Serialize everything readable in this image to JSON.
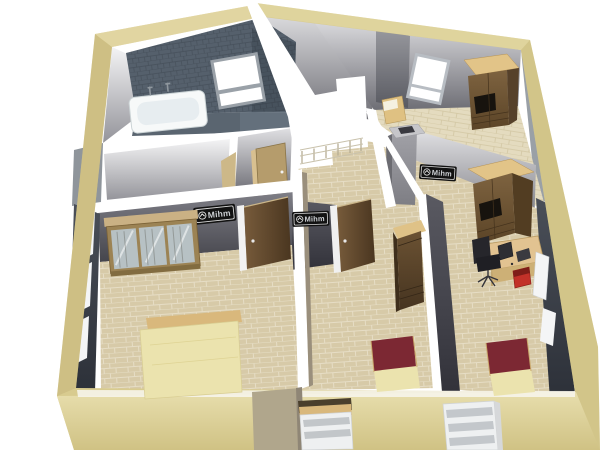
{
  "watermark": {
    "label": "Mihm"
  },
  "palette": {
    "bg": "#ffffff",
    "beige": "#d8cb8f",
    "beige-light": "#e9dfb0",
    "beige-dark": "#c3b479",
    "tile-floor": "#d7caa8",
    "tile-line": "#e6ddc5",
    "wood-floor": "#e4dbbf",
    "wood-line": "#d2c6a2",
    "bath-tile": "#55606c",
    "bath-tile-line": "#46505b",
    "tub-white": "#f7f9f9",
    "furniture-wood-top": "#e2c488",
    "door-light": "#b59c6c",
    "bed-cream": "#ebe3ae",
    "bed-maroon": "#7c2833",
    "bed-frame-tan": "#d9b87c",
    "glass": "#b7c1c4",
    "chair-black": "#26262b",
    "box-red": "#c23129",
    "railing": "#b6ad94",
    "plate-bg": "#121212",
    "plate-border": "#d8d8d8",
    "plate-text": "#cdd0d4",
    "window-white": "#f4f5f6"
  },
  "scene": {
    "type": "3d-floorplan-render",
    "view": "upper-floor-cutaway",
    "exterior": {
      "front_windows": 2,
      "wall_color": "#d8cb8f"
    },
    "rooms": [
      {
        "name": "bathroom",
        "items": [
          "bathtub",
          "taps",
          "window",
          "tiled-wall"
        ]
      },
      {
        "name": "bedroom-left",
        "items": [
          "glass-wardrobe",
          "bed-cream",
          "open-door",
          "watermark-plate",
          "side-windows"
        ]
      },
      {
        "name": "hallway",
        "items": [
          "stair-opening",
          "stair-railing",
          "door"
        ]
      },
      {
        "name": "bedroom-top-right",
        "items": [
          "window",
          "wardrobe",
          "small-bed"
        ]
      },
      {
        "name": "bedroom-middle",
        "items": [
          "open-door",
          "tall-wardrobe",
          "bed-maroon",
          "watermark-plate"
        ]
      },
      {
        "name": "bedroom-right",
        "items": [
          "chimney",
          "wardrobe",
          "desk",
          "computer",
          "office-chair",
          "red-box",
          "bed-maroon",
          "watermark-plate",
          "windows"
        ]
      }
    ]
  }
}
